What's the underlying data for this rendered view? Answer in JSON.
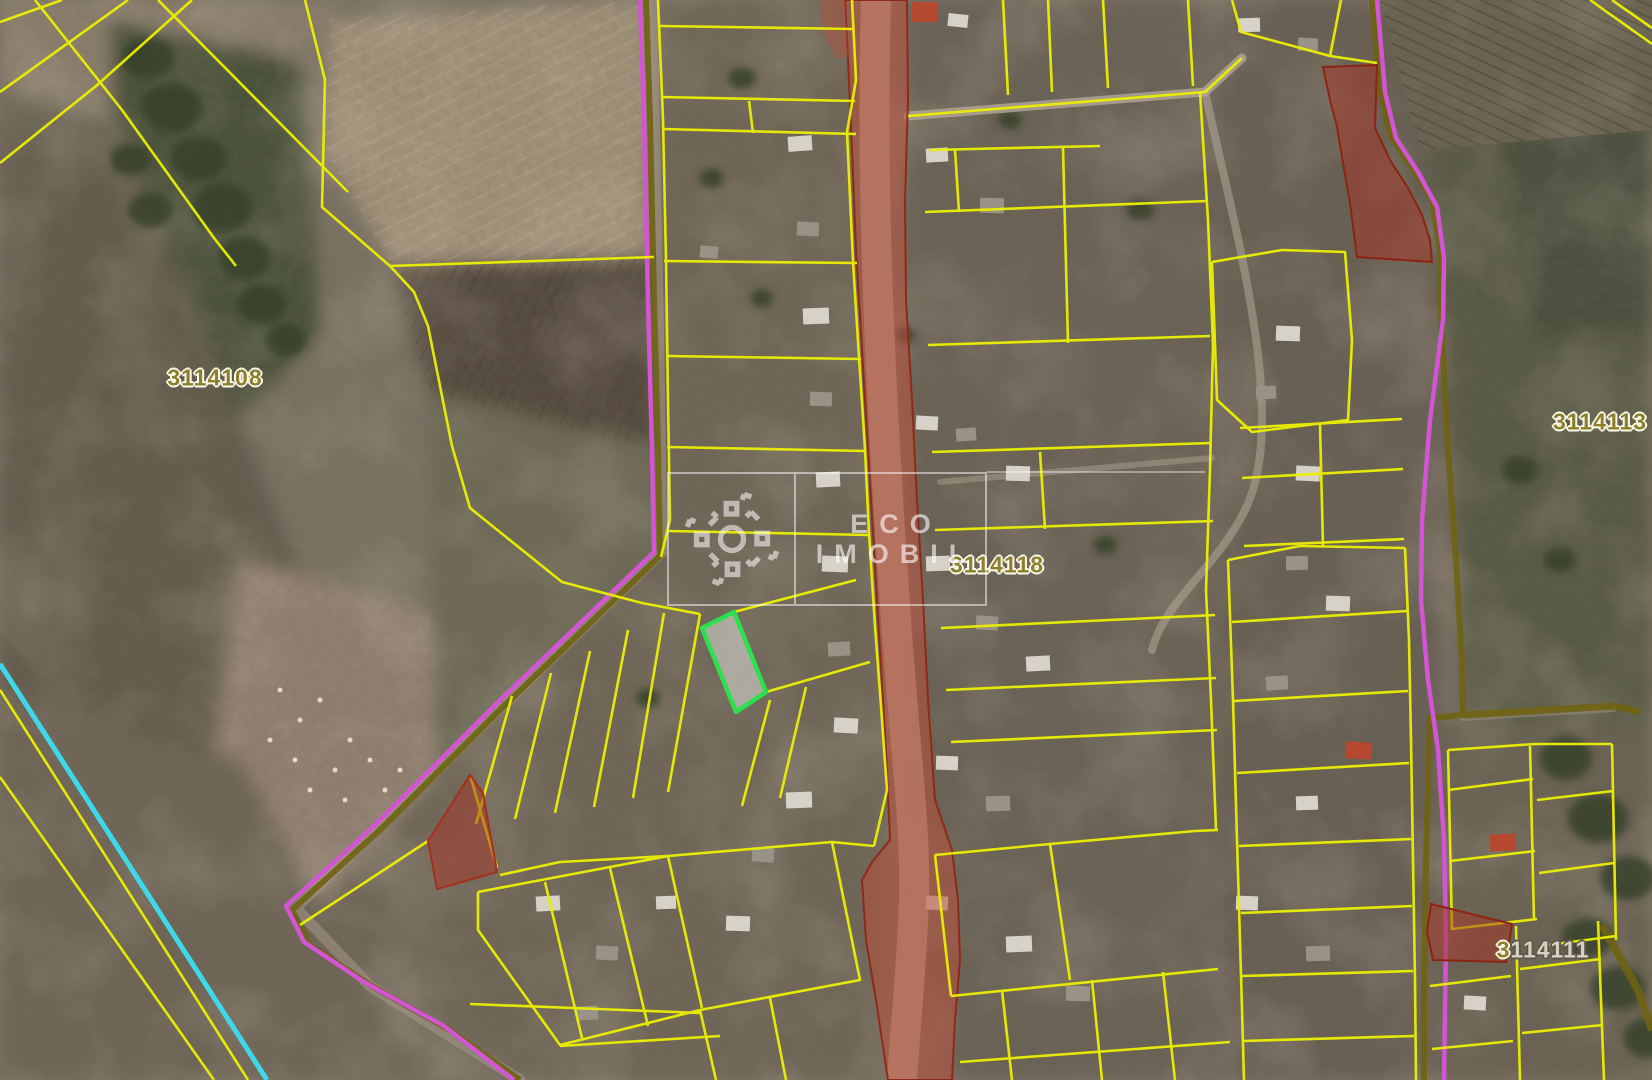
{
  "watermark": {
    "brand_line1": "ECO",
    "brand_line2": "IMOBIL",
    "logo_icon": "eco-imobil-logo-icon"
  },
  "cadastral_labels": {
    "left_field": "3114108",
    "right_field": "3114113",
    "village_center": "3114118",
    "bottom_right_prefix": "3",
    "bottom_right_rest": "114111"
  },
  "legend_colors": {
    "parcel_boundary": "#ecf000",
    "selected_parcel_outline": "#2ce04e",
    "selected_parcel_fill": "rgba(210,210,205,0.62)",
    "flagged_parcel_fill": "rgba(165,52,36,0.5)",
    "flagged_parcel_border": "#8c2413",
    "route_line": "#d355d4",
    "road_overlay": "#b9503a",
    "track_line": "#6f6312",
    "utility_line": "#3ed8ea",
    "label_color": "#8d7f2c"
  }
}
